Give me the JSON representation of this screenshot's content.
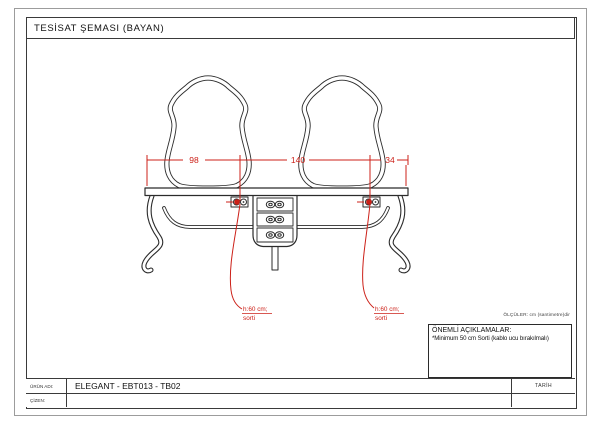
{
  "title_bar": {
    "title": "TESİSAT ŞEMASI (BAYAN)"
  },
  "drawing": {
    "dimension_line": {
      "left": "98",
      "center": "140",
      "right": "34"
    },
    "outlet_note_left": {
      "height": "h:60 cm;",
      "label": "sorti"
    },
    "outlet_note_right": {
      "height": "h:60 cm;",
      "label": "sorti"
    },
    "units_note": "ÖLÇÜLER: cm (santimetre)dir"
  },
  "important_notes": {
    "heading": "ÖNEMLİ AÇIKLAMALAR:",
    "note": "*Minimum 50 cm Sorti (kablo ucu bırakılmalı)"
  },
  "title_block": {
    "product_name_label": "ÜRÜN ADI:",
    "product_name_value": "ELEGANT - EBT013 - TB02",
    "drawn_by_label": "ÇİZEN:",
    "drawn_by_value": "",
    "date_label": "TARİH",
    "date_value": ""
  },
  "colors": {
    "annotation_red": "#cc2018",
    "line_dark": "#2b2b2b",
    "frame_gray": "#9c9c9c"
  }
}
